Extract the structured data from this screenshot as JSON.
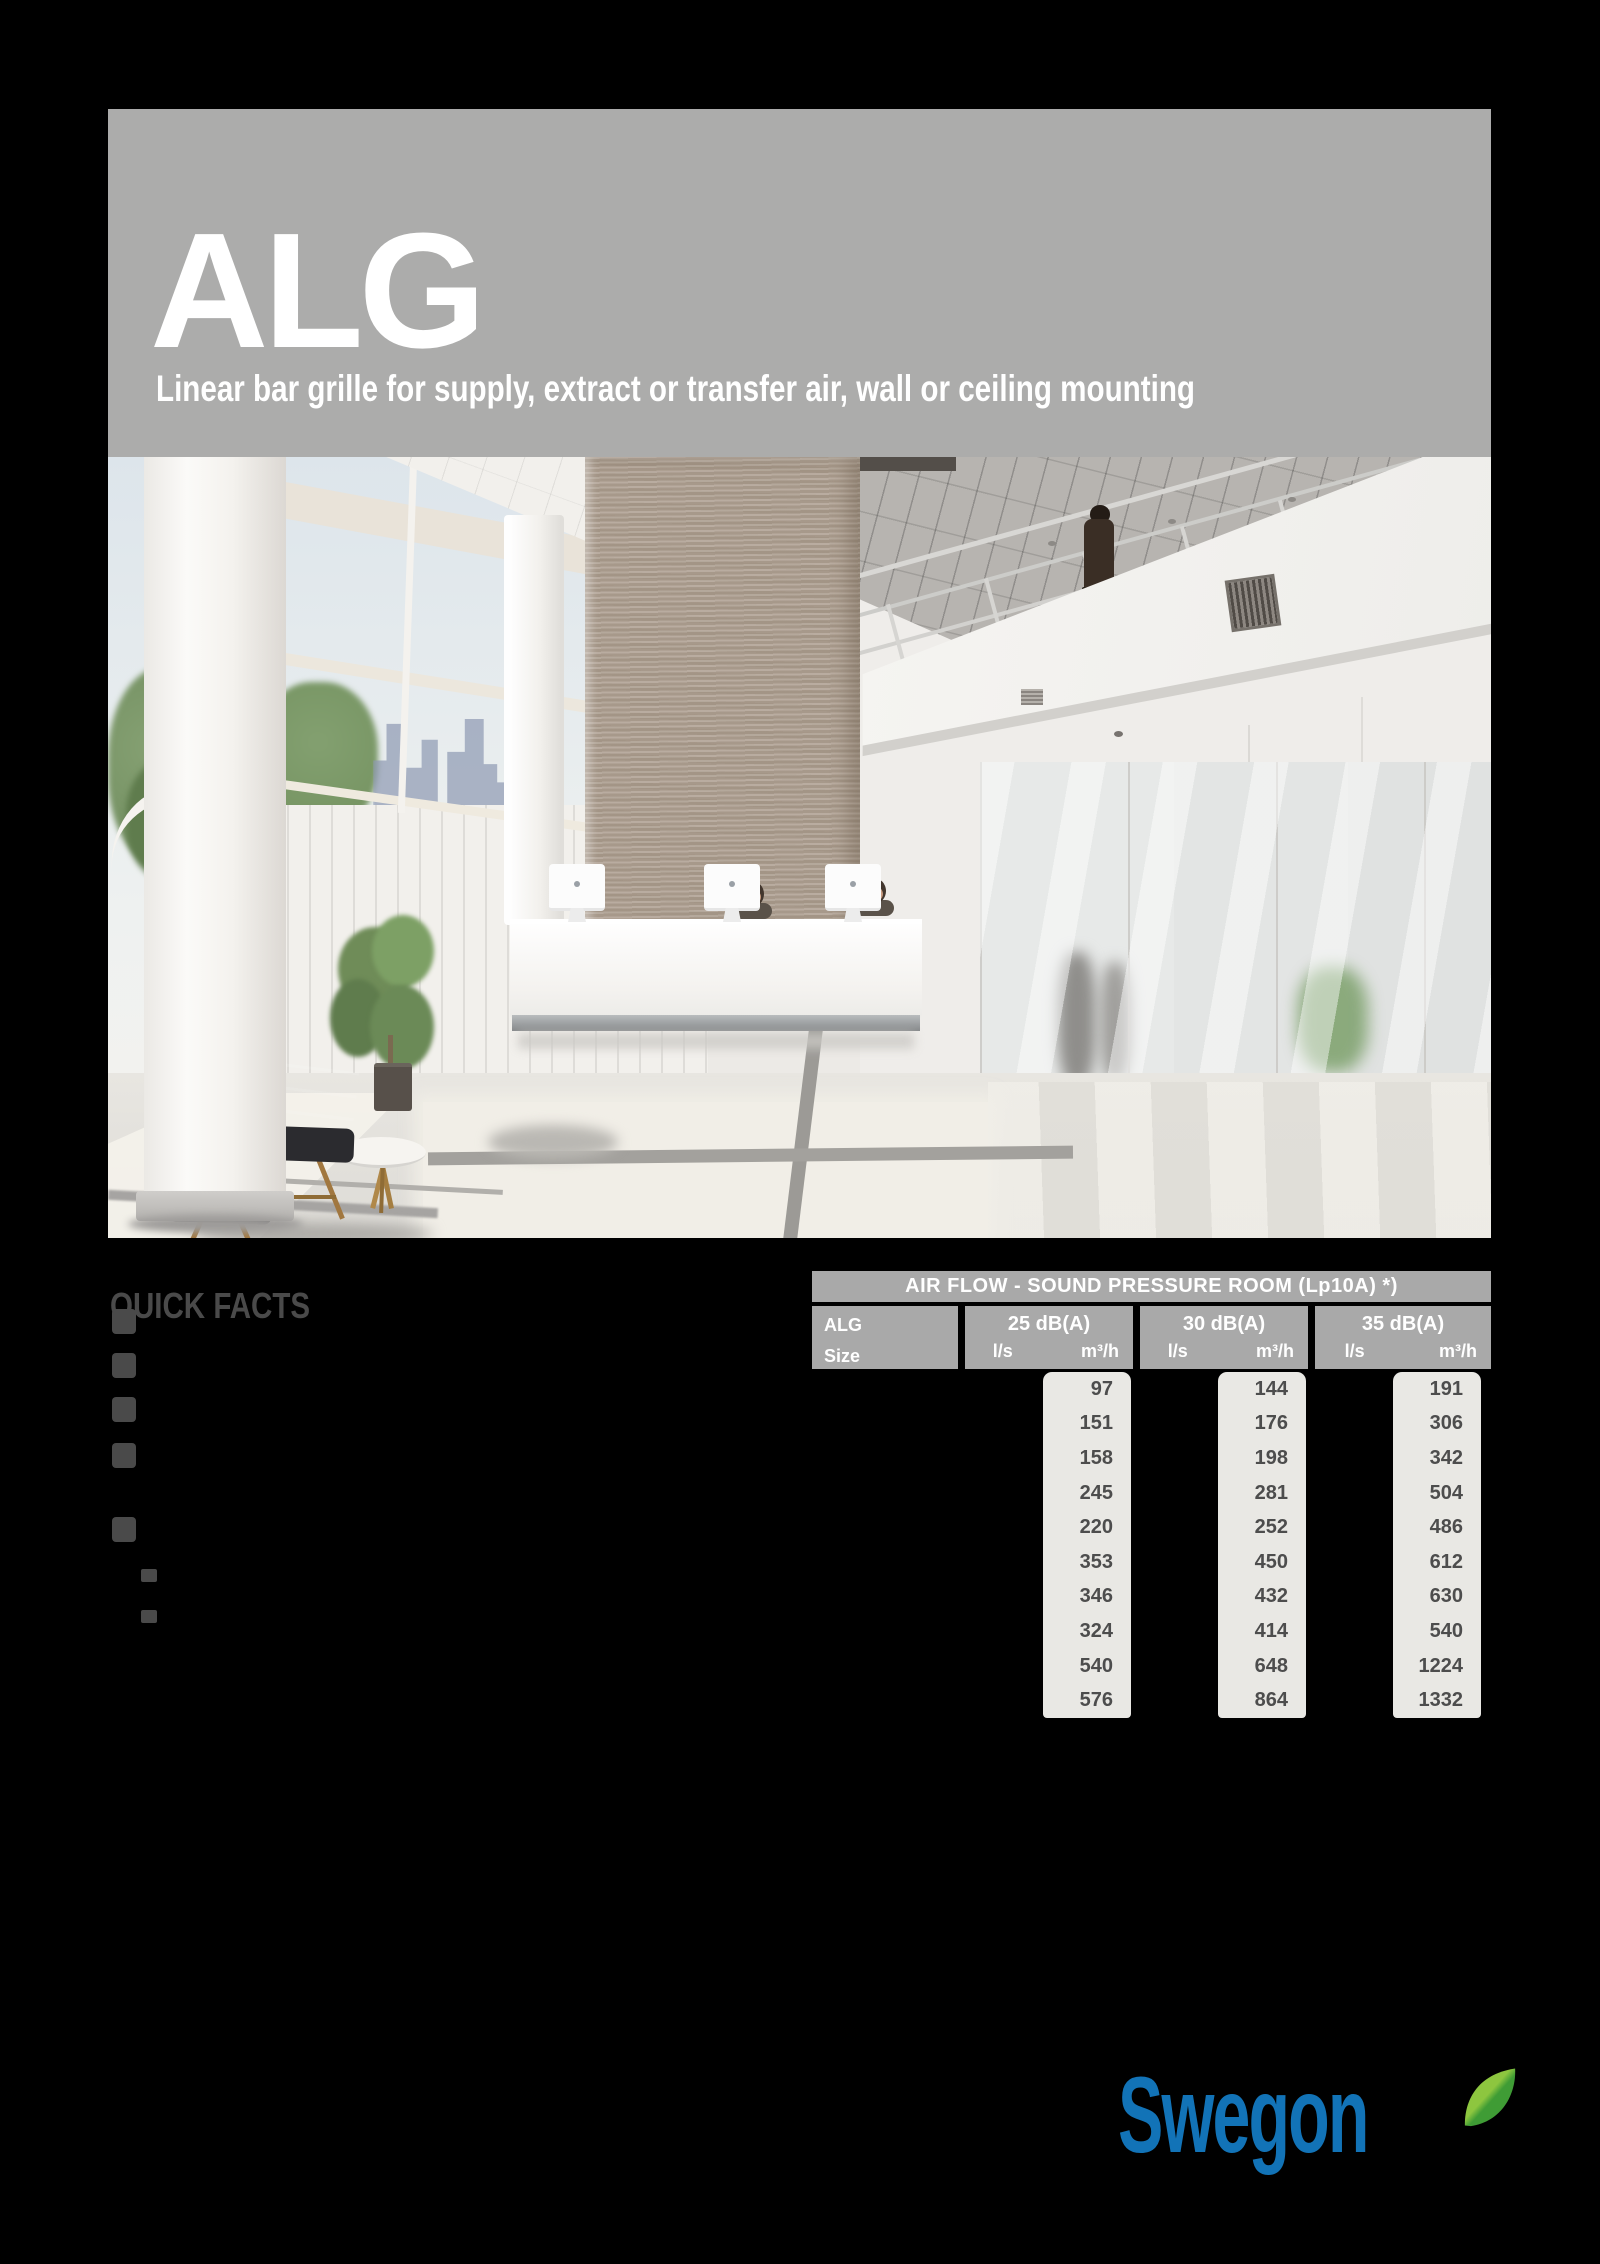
{
  "header": {
    "product": "ALG",
    "subtitle": "Linear bar grille for supply, extract or transfer air, wall or ceiling mounting"
  },
  "quick_facts": {
    "heading": "QUICK FACTS",
    "bullet_count": 5,
    "sub_bullet_count": 2
  },
  "table": {
    "title": "AIR FLOW - SOUND PRESSURE ROOM (Lp10A) *)",
    "row_header": {
      "line1": "ALG",
      "line2": "Size"
    },
    "units": {
      "flow": "l/s",
      "volume": "m³/h"
    },
    "columns": [
      {
        "label": "25 dB(A)",
        "values": [
          97,
          151,
          158,
          245,
          220,
          353,
          346,
          324,
          540,
          576
        ]
      },
      {
        "label": "30 dB(A)",
        "values": [
          144,
          176,
          198,
          281,
          252,
          450,
          432,
          414,
          648,
          864
        ]
      },
      {
        "label": "35 dB(A)",
        "values": [
          191,
          306,
          342,
          504,
          486,
          612,
          630,
          540,
          1224,
          1332
        ]
      }
    ]
  },
  "logo": {
    "text": "Swegon"
  },
  "colors": {
    "band_gray": "#acacab",
    "table_header_gray": "#a9a9a9",
    "table_cell_bg": "#e9e8e4",
    "value_text": "#4d4d4d",
    "facts_text": "#4a4a4a",
    "brand_blue": "#1273b7",
    "leaf_green_light": "#8dc63f",
    "leaf_green_dark": "#3f9c35"
  }
}
